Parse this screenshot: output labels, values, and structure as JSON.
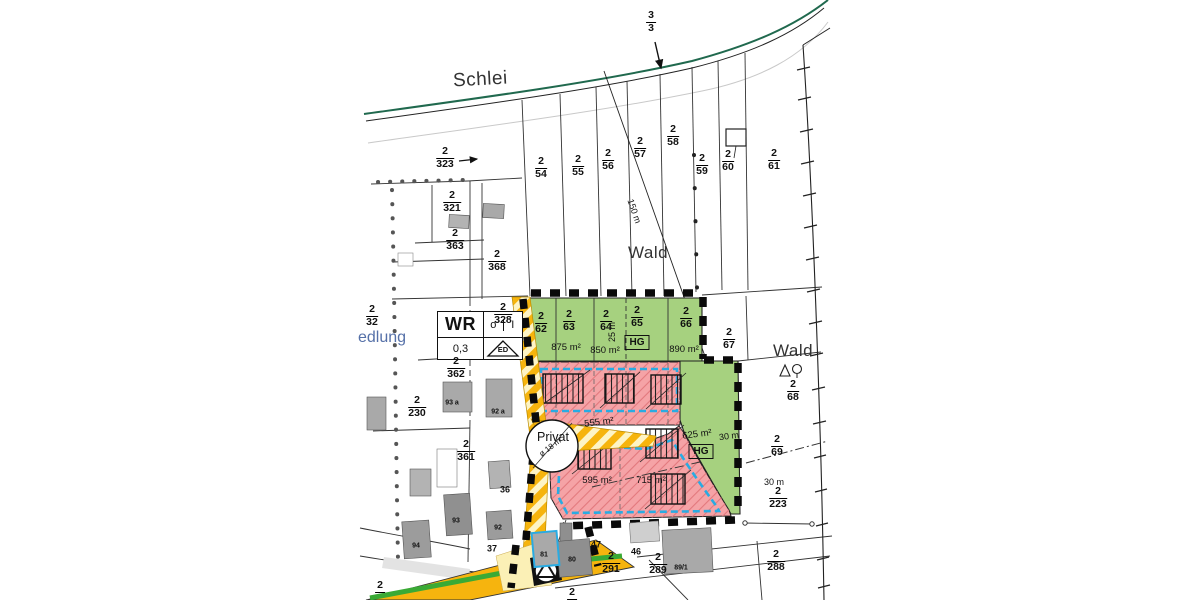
{
  "colors": {
    "green_zone": "#a6d17f",
    "pink_zone": "#f5a3a6",
    "cyan_boundary": "#29abe2",
    "road_yellow": "#f6b40e",
    "road_green_stripe": "#3aaa35",
    "schlei_line_green": "#20694e",
    "siedlung_text_blue": "#5570a8"
  },
  "labels": {
    "schlei": "Schlei",
    "wald_upper": "Wald",
    "wald_right": "Wald",
    "siedlung_partial": "edlung",
    "privat": "Privat",
    "privat_diameter": "ø 18 m",
    "dim_25m": "25 m",
    "dim_150m": "150 m",
    "dim_30m_green": "30 m",
    "dim_30m_right": "30 m",
    "hg_upper": "HG",
    "hg_lower": "HG"
  },
  "wr_box": {
    "zone": "WR",
    "storeys_open": "o",
    "storeys_bar": "I",
    "grz": "0,3",
    "house_type": "ED"
  },
  "areas": {
    "a875": "875 m²",
    "a850": "850 m²",
    "a890": "890 m²",
    "a555": "555 m²",
    "a625": "625 m²",
    "a595": "595 m²",
    "a715": "715 m²"
  },
  "parcels": {
    "f3_3": {
      "num": "3",
      "den": "3"
    },
    "f2_32": {
      "num": "2",
      "den": "32"
    },
    "f2_323": {
      "num": "2",
      "den": "323"
    },
    "f2_321": {
      "num": "2",
      "den": "321"
    },
    "f2_363": {
      "num": "2",
      "den": "363"
    },
    "f2_368": {
      "num": "2",
      "den": "368"
    },
    "f2_328": {
      "num": "2",
      "den": "328"
    },
    "f2_54": {
      "num": "2",
      "den": "54"
    },
    "f2_55": {
      "num": "2",
      "den": "55"
    },
    "f2_56": {
      "num": "2",
      "den": "56"
    },
    "f2_57": {
      "num": "2",
      "den": "57"
    },
    "f2_58": {
      "num": "2",
      "den": "58"
    },
    "f2_59": {
      "num": "2",
      "den": "59"
    },
    "f2_60": {
      "num": "2",
      "den": "60"
    },
    "f2_61": {
      "num": "2",
      "den": "61"
    },
    "f2_62": {
      "num": "2",
      "den": "62"
    },
    "f2_63": {
      "num": "2",
      "den": "63"
    },
    "f2_64": {
      "num": "2",
      "den": "64"
    },
    "f2_65": {
      "num": "2",
      "den": "65"
    },
    "f2_66": {
      "num": "2",
      "den": "66"
    },
    "f2_67": {
      "num": "2",
      "den": "67"
    },
    "f2_68": {
      "num": "2",
      "den": "68"
    },
    "f2_69": {
      "num": "2",
      "den": "69"
    },
    "f2_223": {
      "num": "2",
      "den": "223"
    },
    "f2_288": {
      "num": "2",
      "den": "288"
    },
    "f2_289": {
      "num": "2",
      "den": "289"
    },
    "f2_291": {
      "num": "2",
      "den": "291"
    },
    "f2_362": {
      "num": "2",
      "den": "362"
    },
    "f2_230": {
      "num": "2",
      "den": "230"
    },
    "f2_361": {
      "num": "2",
      "den": "361"
    }
  },
  "cut_labels": {
    "bottom_left_num": "2",
    "bottom_mid_num": "2"
  },
  "house_numbers": {
    "h93a": "93 a",
    "h92a": "92 a",
    "h92": "92",
    "h93": "93",
    "h94": "94",
    "h36": "36",
    "h37": "37",
    "h47": "47",
    "h46": "46",
    "h81": "81",
    "h80": "80",
    "h89_1": "89/1"
  }
}
